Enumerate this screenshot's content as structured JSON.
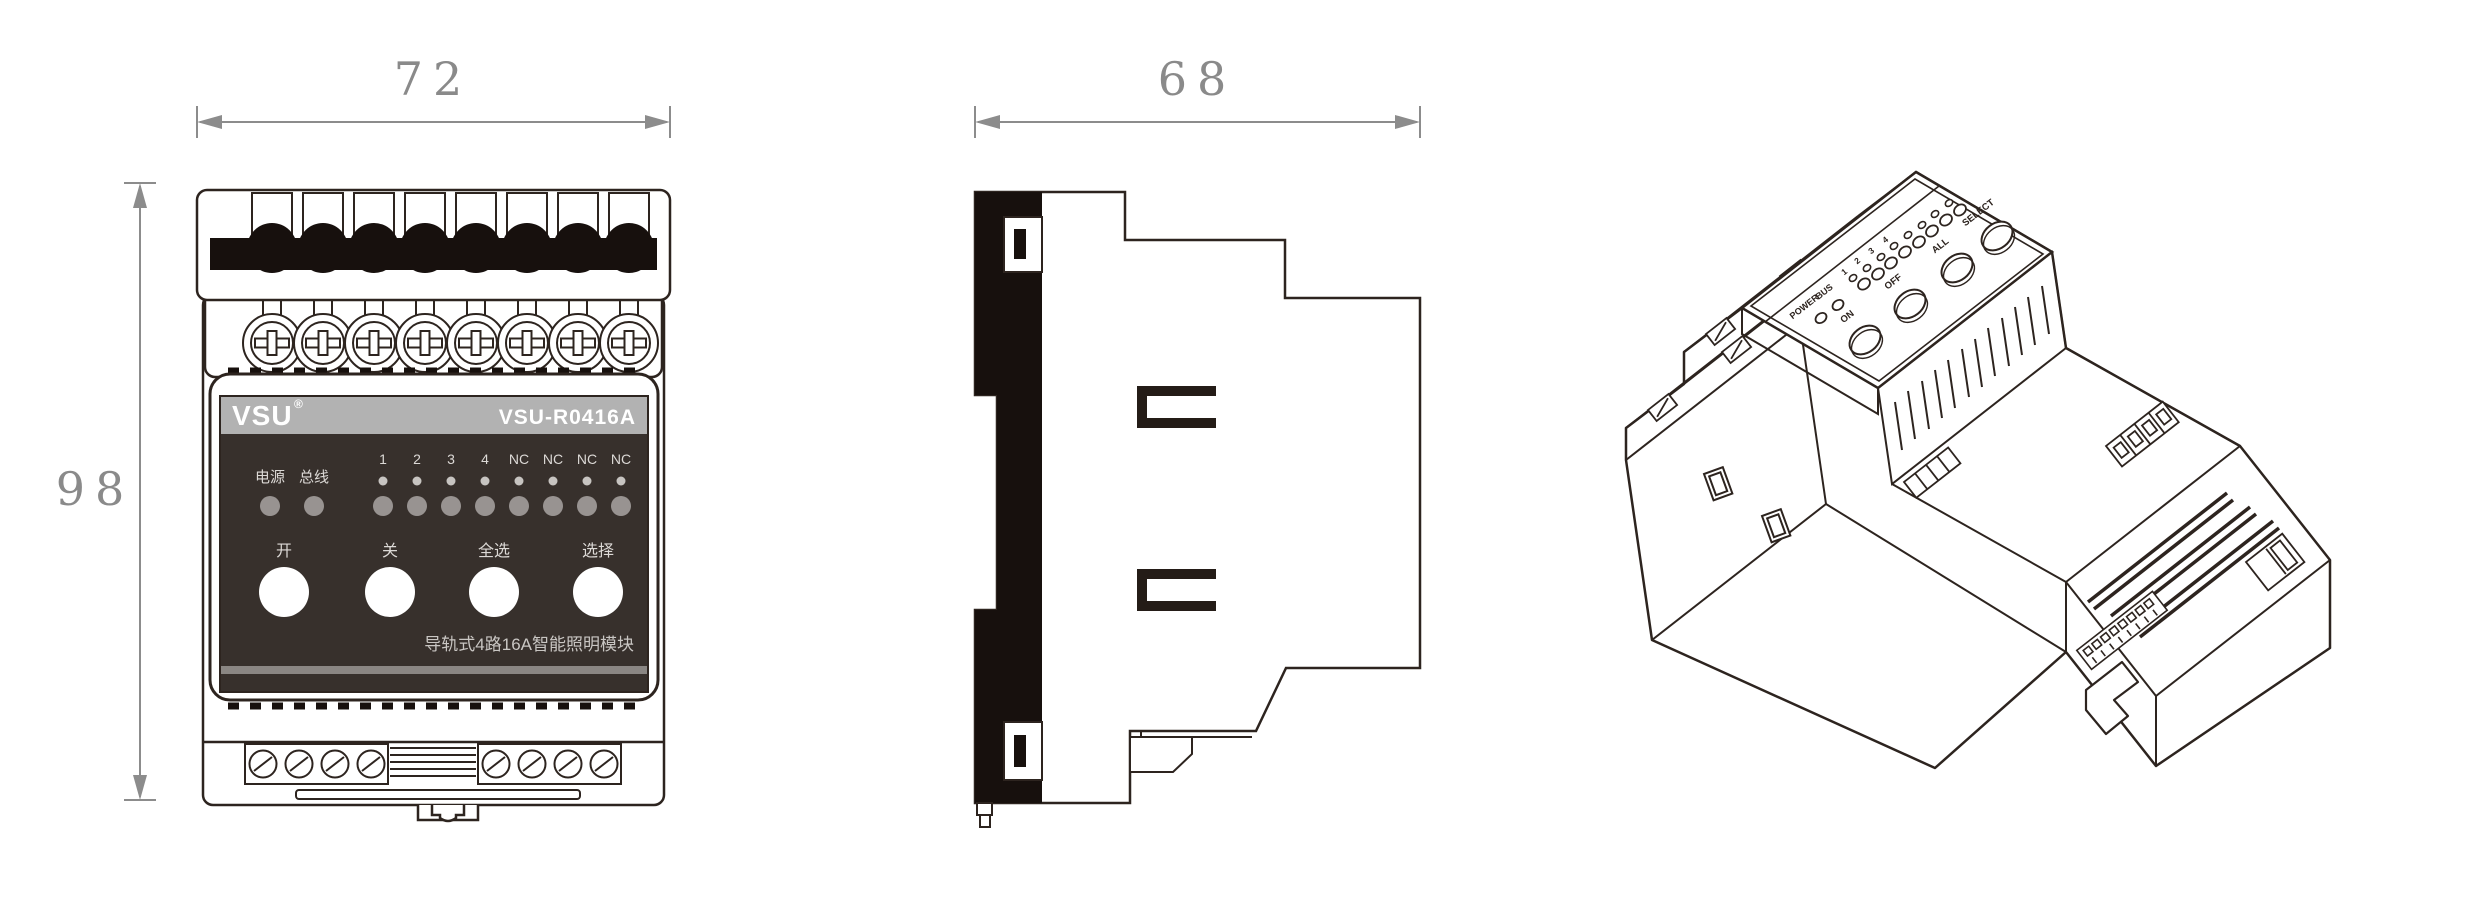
{
  "dimensions": {
    "front_width": "72",
    "front_height": "98",
    "side_depth": "68"
  },
  "front_view": {
    "brand": "VSU",
    "brand_reg": "®",
    "model": "VSU-R0416A",
    "power_led_label": "电源",
    "bus_led_label": "总线",
    "channel_labels": [
      "1",
      "2",
      "3",
      "4",
      "NC",
      "NC",
      "NC",
      "NC"
    ],
    "buttons": [
      {
        "label": "开"
      },
      {
        "label": "关"
      },
      {
        "label": "全选"
      },
      {
        "label": "选择"
      }
    ],
    "caption": "导轨式4路16A智能照明模块"
  },
  "iso_view": {
    "power_label": "POWER",
    "bus_label": "BUS",
    "channel_labels": [
      "1",
      "2",
      "3",
      "4"
    ],
    "button_labels": [
      "ON",
      "OFF",
      "ALL",
      "SELECT"
    ]
  },
  "colors": {
    "line": "#2d241f",
    "black_fill": "#17100d",
    "panel": "#37302c",
    "panel_stripe": "#8a8683",
    "strip": "#b2b2b2",
    "led": "#989391",
    "led_small": "#c7c4c1",
    "dim": "#8c8c8c"
  }
}
